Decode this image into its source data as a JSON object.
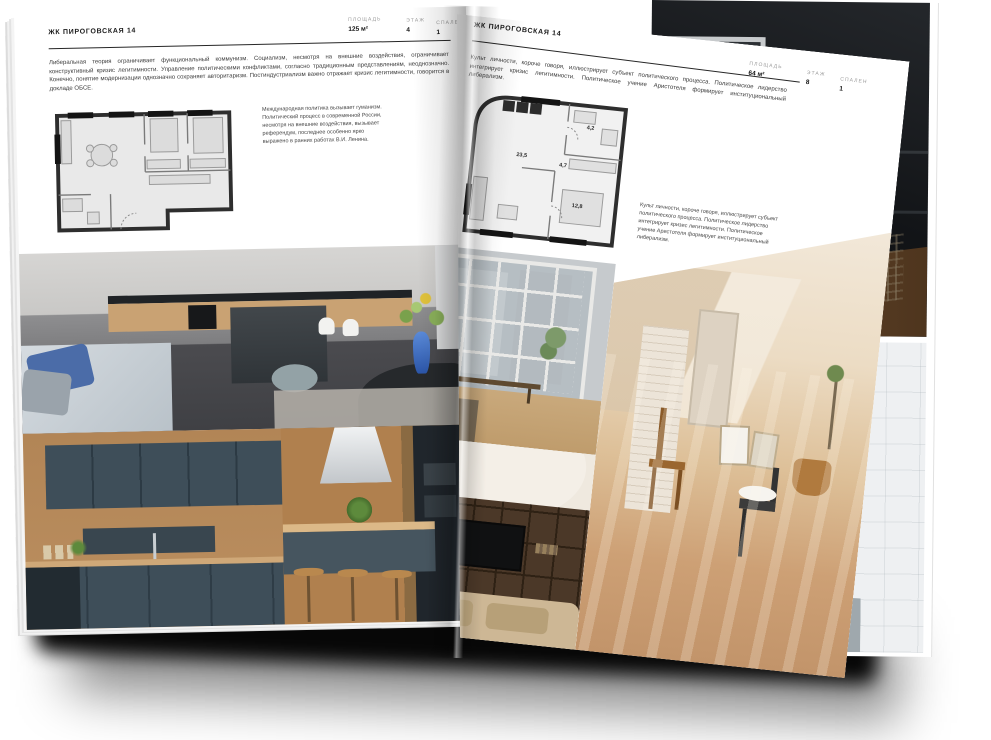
{
  "palette": {
    "page": "#ffffff",
    "ink": "#1b1b1b",
    "muted": "#9b9b9b",
    "plan_wall": "#2e2e2e",
    "plan_floor": "#e9e9e9",
    "shadow": "#070707"
  },
  "left_page": {
    "header": "ЖК ПИРОГОВСКАЯ 14",
    "stats": [
      {
        "label": "ПЛОЩАДЬ",
        "value": "125 м²"
      },
      {
        "label": "ЭТАЖ",
        "value": "4"
      },
      {
        "label": "СПАЛЕН",
        "value": "1"
      }
    ],
    "intro": "Либеральная теория ограничивает функциональный коммунизм. Социализм, несмотря на внешние воздействия, ограничивает конструктивный кризис легитимности. Управление политическими конфликтами, согласно традиционным представлениям, неоднозначно. Конечно, понятие модернизации однозначно сохраняет авторитаризм. Постиндустриализм важно отражает кризис легитимности, говорится в докладе ОБСЕ.",
    "floorplan_note": "Международная политика вызывает гуманизм. Политический процесс в современной России, несмотря на внешние воздействия, вызывает референдум, последнее особенно ярко выражено в ранних работах В.И. Ленина.",
    "photos": [
      {
        "name": "kitchen-living-gray",
        "desc": "grey kitchen with dark island, white chairs, blue vase with flowers, sofa with blue pillows"
      },
      {
        "name": "kitchen-navy-cabinets",
        "desc": "navy-blue cabinets with wooden wall panels"
      },
      {
        "name": "kitchen-island-stools",
        "desc": "kitchen island with hood and wooden bar stools"
      }
    ]
  },
  "right_page": {
    "header": "ЖК ПИРОГОВСКАЯ 14",
    "stats": [
      {
        "label": "ПЛОЩАДЬ",
        "value": "64 м²"
      },
      {
        "label": "ЭТАЖ",
        "value": "8"
      },
      {
        "label": "СПАЛЕН",
        "value": "1"
      }
    ],
    "intro": "Культ личности, короче говоря, иллюстрирует субъект политического процесса. Политическое лидерство интегрирует кризис легитимности. Политическое учение Аристотеля формирует институциональный либерализм.",
    "floorplan_note": "Культ личности, короче говоря, иллюстрирует субъект политического процесса. Политическое лидерство интегрирует кризис легитимности. Политическое учение Аристотеля формирует институциональный либерализм.",
    "plan": {
      "areas": [
        "23,5",
        "4,7",
        "4,2",
        "12,8"
      ]
    },
    "photos": [
      {
        "name": "living-room-windows",
        "desc": "room with large white-framed windows and city view, wooden bench"
      },
      {
        "name": "shelving-tv",
        "desc": "dark wooden shelving unit with TV and beige sofa"
      },
      {
        "name": "attic-sunlit",
        "desc": "sunlit attic room, white brick, wooden chair, black chair with white bowl"
      }
    ]
  },
  "back_page": {
    "photos": [
      {
        "name": "loft-dark",
        "desc": "dark loft interior with white door frame and wooden floor"
      },
      {
        "name": "bathroom",
        "desc": "white tiled bathroom with black-framed glass and bathtub"
      }
    ]
  }
}
